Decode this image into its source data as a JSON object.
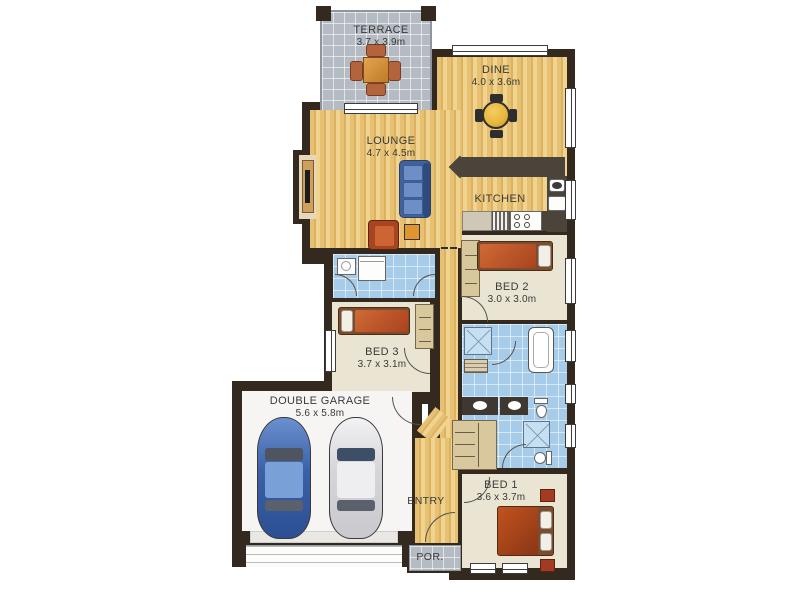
{
  "rooms": {
    "terrace": {
      "label": "TERRACE",
      "dims": "3.7 x 3.9m"
    },
    "dine": {
      "label": "DINE",
      "dims": "4.0 x 3.6m"
    },
    "lounge": {
      "label": "LOUNGE",
      "dims": "4.7 x 4.5m"
    },
    "kitchen": {
      "label": "KITCHEN"
    },
    "bed2": {
      "label": "BED 2",
      "dims": "3.0 x 3.0m"
    },
    "bed3": {
      "label": "BED 3",
      "dims": "3.7 x 3.1m"
    },
    "garage": {
      "label": "DOUBLE GARAGE",
      "dims": "5.6 x 5.8m"
    },
    "entry": {
      "label": "ENTRY"
    },
    "bed1": {
      "label": "BED 1",
      "dims": "3.6 x 3.7m"
    },
    "porch": {
      "label": "POR."
    }
  },
  "colors": {
    "wall": "#33291f",
    "wood_floor": "#e5bf72",
    "tile_blue": "#a7cce9",
    "tile_gray": "#b5bbc2",
    "carpet_beige": "#eae4d2",
    "garage_floor": "#f6f5f3",
    "bench_dark": "#4a443b",
    "bed_red": "#bf5a2d",
    "sofa_blue": "#4d6fa8",
    "car_blue": "#3f66ae",
    "car_white": "#e9e9ec",
    "table_yellow": "#e9b83e"
  }
}
